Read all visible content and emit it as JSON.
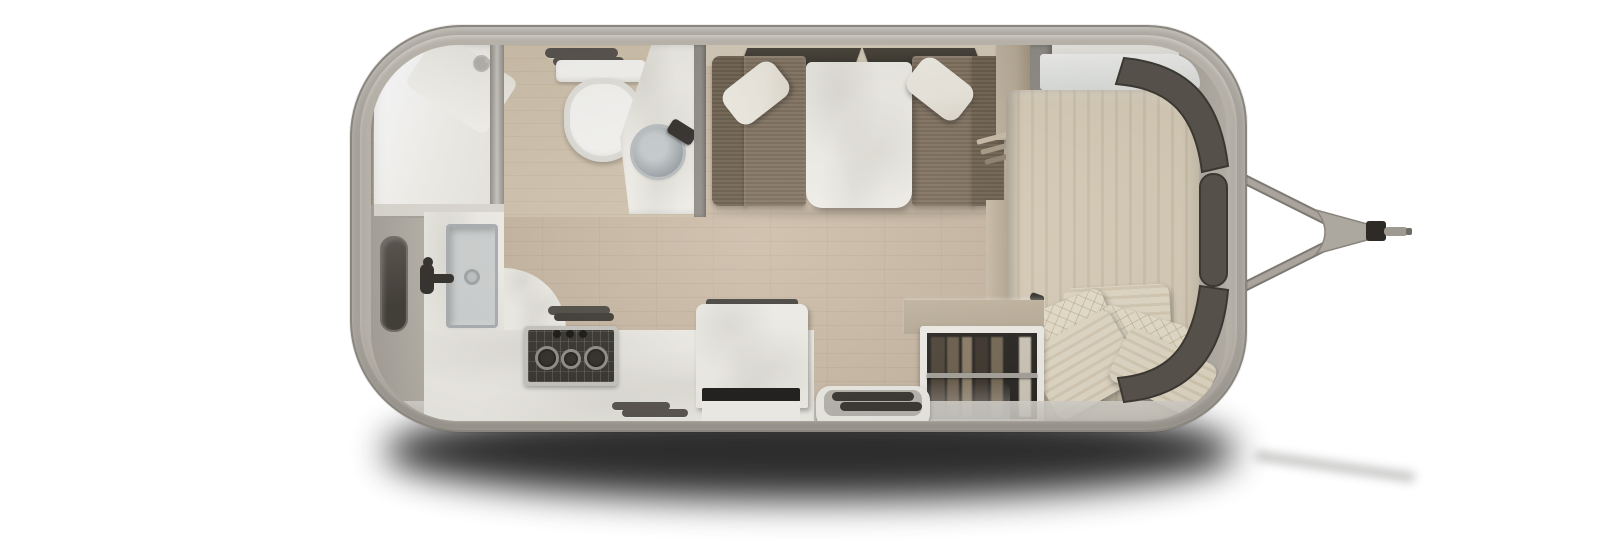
{
  "meta": {
    "title": "Travel trailer floor plan – overhead 3D render"
  },
  "colors": {
    "shell": "#a9a49c",
    "shellEdge": "#8a857d",
    "rim": "#b6b1a8",
    "floor": "#c9b8a2",
    "bathFloor": "#cfc1ab",
    "wall": "#d4cab8",
    "white": "#f6f5f2",
    "marble": "#efede6",
    "bench": "#7d6e5b",
    "benchDark": "#6a5c4a",
    "pillow": "#ece8de",
    "bed": "#d8cdb8",
    "bedStripe": "#cdc2ab",
    "bedPillow": "#e3dac6",
    "ventDark": "#55504a",
    "windowGlass": "#55514a",
    "windowEdge": "#3b3832",
    "steel": "#c6c4be",
    "applianceDark": "#34312c",
    "grate": "#8e8b84",
    "wardrobeDark": "#262320",
    "cabinetTan": "#b7aa96",
    "grayWall": "#8f8b85",
    "stepTray": "#b7b4ad",
    "tvDark": "#1b1917",
    "fixtureDark": "#2e2b27",
    "hitch": "#a29d95",
    "hitchPlate": "#ada89f",
    "shadow": "#000000"
  },
  "regions": {
    "canvas": "Trailer floor plan render",
    "body": "Trailer body shell",
    "hitch": "Tow hitch A-frame",
    "shower": "Shower stall",
    "toilet": "Toilet",
    "vanity": "Bathroom vanity with vessel sink",
    "benchLeft": "Dinette bench (left)",
    "benchRight": "Dinette bench (right)",
    "table": "Dinette table",
    "curtain": "Accordion privacy curtain",
    "cabinet": "Overhead cabinet",
    "bed": "Bed with pillows",
    "wardrobe": "Wardrobe with hanging clothes",
    "counter": "Kitchen counter",
    "sink": "Kitchen sink",
    "cooktop": "Gas cooktop",
    "fridge": "Refrigerator / TV cabinet",
    "step": "Entry step",
    "windowSide": "Side window",
    "windowCurved": "Curved front windows"
  }
}
